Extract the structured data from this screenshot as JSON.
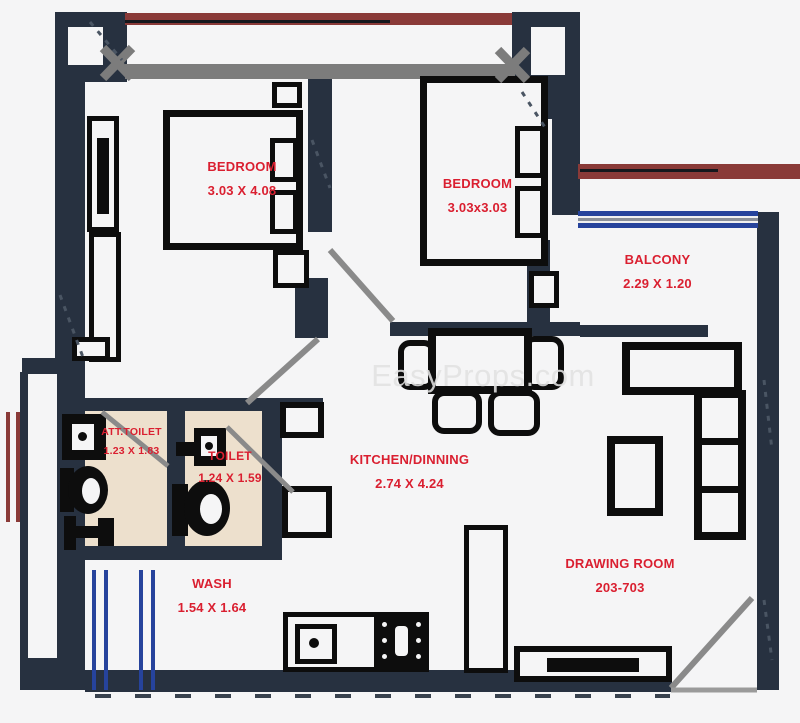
{
  "watermark": "EasyProps.com",
  "rooms": [
    {
      "id": "bedroom-1",
      "name": "BEDROOM",
      "dims": "3.03 X 4.08"
    },
    {
      "id": "bedroom-2",
      "name": "BEDROOM",
      "dims": "3.03x3.03"
    },
    {
      "id": "balcony",
      "name": "BALCONY",
      "dims": "2.29 X 1.20"
    },
    {
      "id": "att-toilet",
      "name": "ATT.TOILET",
      "dims": "1.23 X 1.83"
    },
    {
      "id": "toilet",
      "name": "TOILET",
      "dims": "1.24 X 1.59"
    },
    {
      "id": "kitchen-dining",
      "name": "KITCHEN/DINNING",
      "dims": "2.74 X 4.24"
    },
    {
      "id": "wash",
      "name": "WASH",
      "dims": "1.54 X 1.64"
    },
    {
      "id": "drawing-room",
      "name": "DRAWING ROOM",
      "dims": "203-703"
    }
  ],
  "colors": {
    "background": "#f5f5f6",
    "wall": "#273140",
    "furniture_line": "#0d0d0d",
    "label_red": "#da1f30",
    "maroon_beam": "#8a3a38",
    "window_blue": "#26439c",
    "toilet_floor": "#ede0cd",
    "door_swing_gray": "#8a8a8a",
    "watermark_gray": "#e2e2e2"
  }
}
